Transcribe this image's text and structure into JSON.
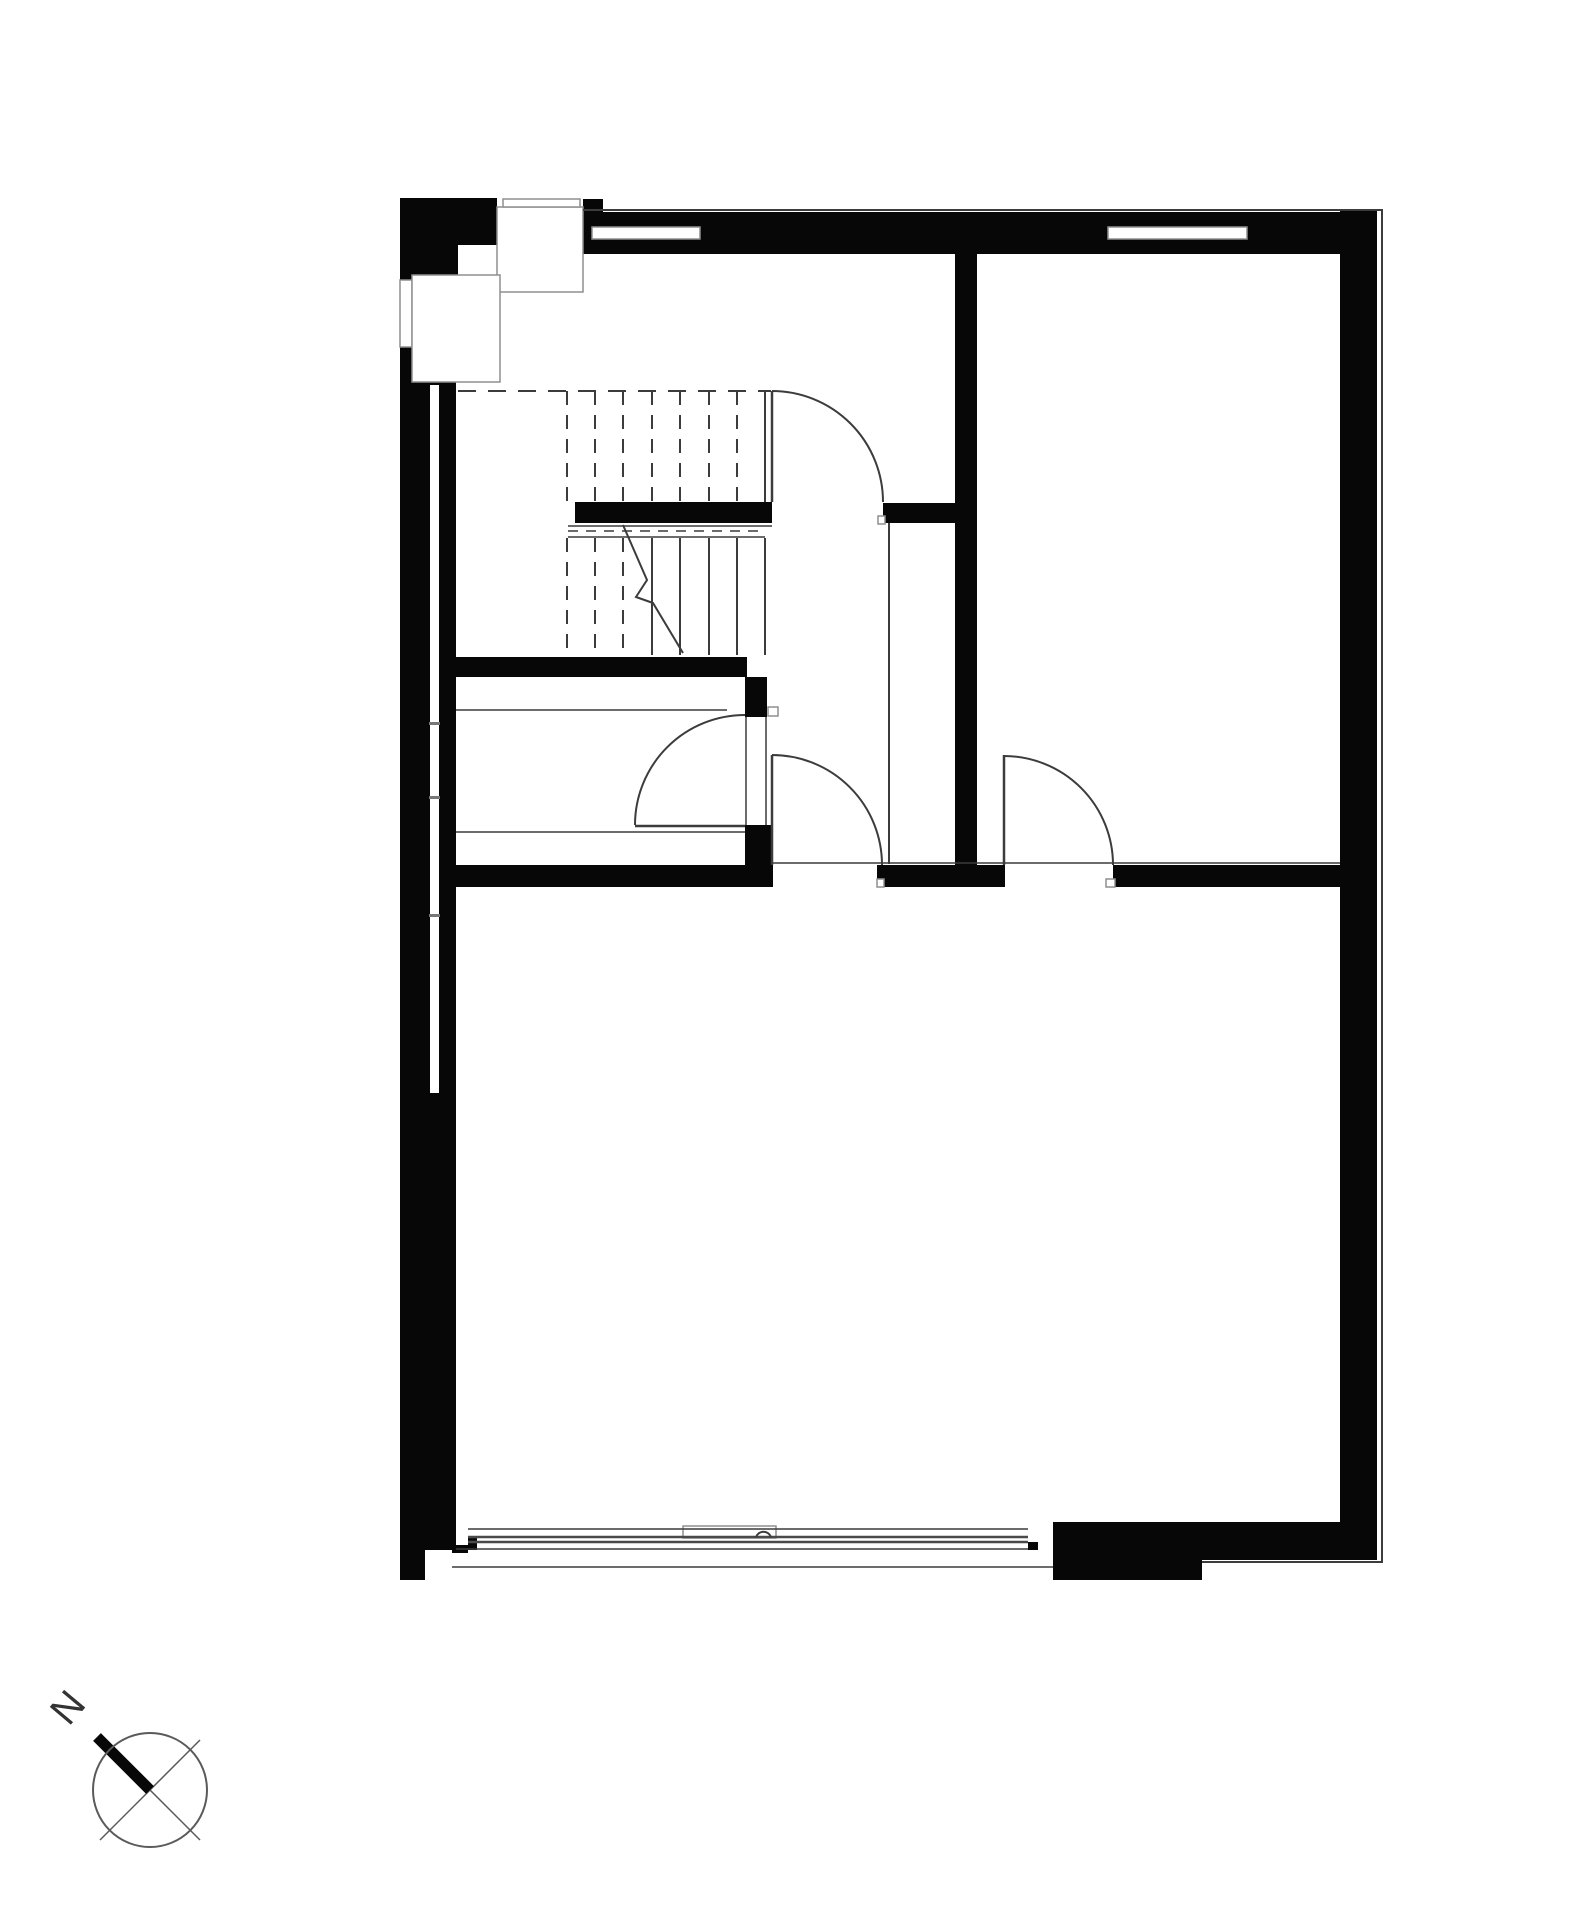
{
  "title": "ground-floor-plan",
  "canvas": {
    "w": 1584,
    "h": 1920,
    "bg": "#ffffff"
  },
  "colors": {
    "wall": "#070707",
    "white": "#ffffff",
    "thin": "#3c3c3c",
    "outline": "#8f8f8f",
    "glass": "#4a4a4a",
    "tick": "#777777",
    "ring": "#5a5a5a",
    "text": "#333333"
  },
  "compass": {
    "label": "N"
  },
  "plan": {
    "rects": [
      {
        "n": "left-exterior-wall",
        "x": 400,
        "y": 198,
        "w": 56,
        "h": 1352,
        "f": "wall"
      },
      {
        "n": "left-wall-foot",
        "x": 400,
        "y": 1550,
        "w": 25,
        "h": 30,
        "f": "wall"
      },
      {
        "n": "sill-stub",
        "x": 452,
        "y": 1545,
        "w": 16,
        "h": 8,
        "f": "wall"
      },
      {
        "n": "top-left-chimney-block-a",
        "x": 400,
        "y": 198,
        "w": 97,
        "h": 47,
        "f": "wall"
      },
      {
        "n": "top-left-chimney-block-b",
        "x": 400,
        "y": 245,
        "w": 58,
        "h": 57,
        "f": "wall"
      },
      {
        "n": "chimney-right-strip",
        "x": 583,
        "y": 199,
        "w": 20,
        "h": 55,
        "f": "wall"
      },
      {
        "n": "top-exterior-wall",
        "x": 497,
        "y": 212,
        "w": 843,
        "h": 42,
        "f": "wall"
      },
      {
        "n": "right-exterior-wall",
        "x": 1340,
        "y": 210,
        "w": 37,
        "h": 1341,
        "f": "wall"
      },
      {
        "n": "stair-landing-half-wall",
        "x": 575,
        "y": 502,
        "w": 197,
        "h": 21,
        "f": "wall"
      },
      {
        "n": "stair-hall-wall-segment",
        "x": 883,
        "y": 503,
        "w": 74,
        "h": 20,
        "f": "wall"
      },
      {
        "n": "interior-wall-vertical",
        "x": 955,
        "y": 254,
        "w": 22,
        "h": 611,
        "f": "wall"
      },
      {
        "n": "under-stair-wall",
        "x": 456,
        "y": 657,
        "w": 291,
        "h": 20,
        "f": "wall"
      },
      {
        "n": "closet-door-jamb-upper",
        "x": 745,
        "y": 677,
        "w": 22,
        "h": 40,
        "f": "wall"
      },
      {
        "n": "closet-door-jamb-lower",
        "x": 745,
        "y": 825,
        "w": 28,
        "h": 62,
        "f": "wall"
      },
      {
        "n": "mid-wall-left",
        "x": 456,
        "y": 865,
        "w": 316,
        "h": 22,
        "f": "wall"
      },
      {
        "n": "mid-wall-center",
        "x": 877,
        "y": 865,
        "w": 128,
        "h": 22,
        "f": "wall"
      },
      {
        "n": "mid-wall-right",
        "x": 1113,
        "y": 865,
        "w": 227,
        "h": 22,
        "f": "wall"
      },
      {
        "n": "bottom-right-wall-block",
        "x": 1053,
        "y": 1522,
        "w": 324,
        "h": 38,
        "f": "wall"
      },
      {
        "n": "bottom-right-wall-step",
        "x": 1053,
        "y": 1560,
        "w": 149,
        "h": 20,
        "f": "wall"
      },
      {
        "n": "glass-end-tick-left",
        "x": 468,
        "y": 1538,
        "w": 9,
        "h": 12,
        "f": "wall"
      },
      {
        "n": "glass-end-tick-right",
        "x": 1028,
        "y": 1542,
        "w": 10,
        "h": 8,
        "f": "wall"
      },
      {
        "n": "chimney-square-b",
        "x": 458,
        "y": 245,
        "w": 39,
        "h": 48,
        "f": "white"
      },
      {
        "n": "left-wall-window-slot",
        "x": 430,
        "y": 385,
        "w": 9,
        "h": 708,
        "f": "white"
      },
      {
        "n": "top-window-1",
        "x": 592,
        "y": 227,
        "w": 108,
        "h": 12,
        "f": "white",
        "s": "outline"
      },
      {
        "n": "top-window-2",
        "x": 1108,
        "y": 227,
        "w": 139,
        "h": 12,
        "f": "white",
        "s": "outline"
      },
      {
        "n": "left-window-upper",
        "x": 400,
        "y": 280,
        "w": 12,
        "h": 67,
        "f": "white",
        "s": "outline"
      },
      {
        "n": "chimney-square-a",
        "x": 497,
        "y": 207,
        "w": 86,
        "h": 85,
        "f": "white",
        "s": "outline"
      },
      {
        "n": "chimney-top-bar",
        "x": 503,
        "y": 199,
        "w": 77,
        "h": 8,
        "f": "white",
        "s": "outline"
      },
      {
        "n": "chimney-square-c",
        "x": 412,
        "y": 275,
        "w": 88,
        "h": 107,
        "f": "white",
        "s": "outline"
      },
      {
        "n": "sliding-door-leaf",
        "x": 683,
        "y": 1526,
        "w": 93,
        "h": 12,
        "f": "white",
        "s": "outline"
      },
      {
        "n": "door-stop-stairs",
        "x": 878,
        "y": 516,
        "w": 7,
        "h": 8,
        "f": "white",
        "s": "outline"
      },
      {
        "n": "door-stop-closet",
        "x": 768,
        "y": 707,
        "w": 10,
        "h": 9,
        "f": "white",
        "s": "outline"
      },
      {
        "n": "door-stop-hall",
        "x": 877,
        "y": 879,
        "w": 7,
        "h": 8,
        "f": "white",
        "s": "outline"
      },
      {
        "n": "door-stop-bedroom",
        "x": 1106,
        "y": 879,
        "w": 9,
        "h": 8,
        "f": "white",
        "s": "outline"
      },
      {
        "n": "slot-tick-1",
        "x": 429,
        "y": 722,
        "w": 11,
        "h": 3,
        "f": "tick"
      },
      {
        "n": "slot-tick-2",
        "x": 429,
        "y": 796,
        "w": 11,
        "h": 3,
        "f": "tick"
      },
      {
        "n": "slot-tick-3",
        "x": 429,
        "y": 914,
        "w": 11,
        "h": 3,
        "f": "tick"
      }
    ],
    "lines": [
      {
        "n": "top-facade-outline",
        "x1": 583,
        "y1": 210,
        "x2": 1383,
        "y2": 210,
        "w": 2
      },
      {
        "n": "right-facade-outline",
        "x1": 1382,
        "y1": 210,
        "x2": 1382,
        "y2": 1562,
        "w": 2
      },
      {
        "n": "stair-top-dashed-line",
        "x1": 458,
        "y1": 391,
        "x2": 771,
        "y2": 391,
        "w": 2,
        "d": "18 12"
      },
      {
        "n": "stair-right-edge",
        "x1": 765,
        "y1": 391,
        "x2": 765,
        "y2": 502,
        "w": 2
      },
      {
        "n": "stair-door-leaf",
        "x1": 772,
        "y1": 391,
        "x2": 772,
        "y2": 502,
        "w": 2.5
      },
      {
        "n": "landing-under-line-1",
        "x1": 568,
        "y1": 526,
        "x2": 772,
        "y2": 526,
        "w": 1.5
      },
      {
        "n": "landing-under-dashed",
        "x1": 568,
        "y1": 531,
        "x2": 765,
        "y2": 531,
        "w": 1.5,
        "d": "10 8"
      },
      {
        "n": "landing-under-line-2",
        "x1": 568,
        "y1": 537,
        "x2": 765,
        "y2": 537,
        "w": 1.5
      },
      {
        "n": "stair-riser-u1",
        "x1": 567,
        "y1": 391,
        "x2": 567,
        "y2": 501,
        "w": 2,
        "d": "14 10"
      },
      {
        "n": "stair-riser-u2",
        "x1": 595,
        "y1": 391,
        "x2": 595,
        "y2": 501,
        "w": 2,
        "d": "14 10"
      },
      {
        "n": "stair-riser-u3",
        "x1": 623,
        "y1": 391,
        "x2": 623,
        "y2": 501,
        "w": 2,
        "d": "14 10"
      },
      {
        "n": "stair-riser-u4",
        "x1": 652,
        "y1": 391,
        "x2": 652,
        "y2": 501,
        "w": 2,
        "d": "14 10"
      },
      {
        "n": "stair-riser-u5",
        "x1": 680,
        "y1": 391,
        "x2": 680,
        "y2": 501,
        "w": 2,
        "d": "14 10"
      },
      {
        "n": "stair-riser-u6",
        "x1": 709,
        "y1": 391,
        "x2": 709,
        "y2": 501,
        "w": 2,
        "d": "14 10"
      },
      {
        "n": "stair-riser-u7",
        "x1": 737,
        "y1": 391,
        "x2": 737,
        "y2": 501,
        "w": 2,
        "d": "14 10"
      },
      {
        "n": "stair-riser-l1",
        "x1": 567,
        "y1": 538,
        "x2": 567,
        "y2": 655,
        "w": 2,
        "d": "14 10"
      },
      {
        "n": "stair-riser-l2",
        "x1": 595,
        "y1": 538,
        "x2": 595,
        "y2": 655,
        "w": 2,
        "d": "14 10"
      },
      {
        "n": "stair-riser-l3",
        "x1": 623,
        "y1": 538,
        "x2": 623,
        "y2": 655,
        "w": 2,
        "d": "14 10"
      },
      {
        "n": "stair-riser-l4",
        "x1": 652,
        "y1": 538,
        "x2": 652,
        "y2": 655,
        "w": 2
      },
      {
        "n": "stair-riser-l5",
        "x1": 680,
        "y1": 538,
        "x2": 680,
        "y2": 655,
        "w": 2
      },
      {
        "n": "stair-riser-l6",
        "x1": 709,
        "y1": 538,
        "x2": 709,
        "y2": 655,
        "w": 2
      },
      {
        "n": "stair-riser-l7",
        "x1": 737,
        "y1": 538,
        "x2": 737,
        "y2": 655,
        "w": 2
      },
      {
        "n": "stair-riser-l8",
        "x1": 765,
        "y1": 538,
        "x2": 765,
        "y2": 655,
        "w": 2
      },
      {
        "n": "hall-partition-line",
        "x1": 889,
        "y1": 523,
        "x2": 889,
        "y2": 864,
        "w": 2
      },
      {
        "n": "closet-shelf-line-1",
        "x1": 456,
        "y1": 710,
        "x2": 727,
        "y2": 710,
        "w": 1.5
      },
      {
        "n": "closet-shelf-line-2",
        "x1": 456,
        "y1": 832,
        "x2": 745,
        "y2": 832,
        "w": 1.5
      },
      {
        "n": "closet-door-frame-left",
        "x1": 746,
        "y1": 717,
        "x2": 746,
        "y2": 825,
        "w": 1.5
      },
      {
        "n": "closet-door-frame-right",
        "x1": 766,
        "y1": 717,
        "x2": 766,
        "y2": 825,
        "w": 1.5
      },
      {
        "n": "closet-door-leaf",
        "x1": 635,
        "y1": 826,
        "x2": 745,
        "y2": 826,
        "w": 2.5
      },
      {
        "n": "hall-door-leaf",
        "x1": 772,
        "y1": 755,
        "x2": 772,
        "y2": 865,
        "w": 2.5
      },
      {
        "n": "bedroom-door-leaf",
        "x1": 1004,
        "y1": 755,
        "x2": 1004,
        "y2": 865,
        "w": 2.5
      },
      {
        "n": "mid-wall-top-line",
        "x1": 772,
        "y1": 863,
        "x2": 1340,
        "y2": 863,
        "w": 1.5
      },
      {
        "n": "slider-track-top",
        "x1": 468,
        "y1": 1529,
        "x2": 1028,
        "y2": 1529,
        "w": 1.5
      },
      {
        "n": "slider-glass-line-1",
        "x1": 468,
        "y1": 1537,
        "x2": 1028,
        "y2": 1537,
        "w": 2.5,
        "c": "glass"
      },
      {
        "n": "slider-glass-line-2",
        "x1": 468,
        "y1": 1542,
        "x2": 1028,
        "y2": 1542,
        "w": 2.5,
        "c": "glass"
      },
      {
        "n": "slider-track-mid",
        "x1": 456,
        "y1": 1549,
        "x2": 1028,
        "y2": 1549,
        "w": 1.5
      },
      {
        "n": "slider-sill-line",
        "x1": 452,
        "y1": 1567,
        "x2": 1053,
        "y2": 1567,
        "w": 1.5
      },
      {
        "n": "bottom-right-outline",
        "x1": 1202,
        "y1": 1562,
        "x2": 1383,
        "y2": 1562,
        "w": 2
      },
      {
        "n": "compass-cross-nw-se",
        "x1": 100,
        "y1": 1740,
        "x2": 200,
        "y2": 1840,
        "w": 1.5,
        "c": "ring"
      },
      {
        "n": "compass-cross-sw-ne",
        "x1": 100,
        "y1": 1840,
        "x2": 200,
        "y2": 1740,
        "w": 1.5,
        "c": "ring"
      },
      {
        "n": "compass-needle",
        "x1": 150,
        "y1": 1790,
        "x2": 97,
        "y2": 1737,
        "w": 11,
        "c": "wall"
      }
    ],
    "paths": [
      {
        "n": "stair-door-arc",
        "d": "M 772 391 A 111 111 0 0 1 883 502",
        "w": 2
      },
      {
        "n": "closet-door-arc",
        "d": "M 635 825 A 110 110 0 0 1 745 715",
        "w": 2
      },
      {
        "n": "hall-door-arc",
        "d": "M 772 755 A 110 110 0 0 1 882 865",
        "w": 2
      },
      {
        "n": "bedroom-door-arc",
        "d": "M 1004 756 A 109 109 0 0 1 1113 865",
        "w": 2
      },
      {
        "n": "stair-cut-line",
        "d": "M 623 525 L 647 580 L 636 597 L 653 603 L 683 653",
        "w": 2
      },
      {
        "n": "slider-handle",
        "d": "M 756 1537 A 8 8 0 0 1 771 1537",
        "w": 2
      }
    ],
    "circles": [
      {
        "n": "compass-ring",
        "cx": 150,
        "cy": 1790,
        "r": 57,
        "w": 2,
        "c": "ring"
      }
    ],
    "texts": [
      {
        "n": "compass-north-label",
        "bind": "compass.label",
        "x": 78,
        "y": 1716,
        "rot": -50,
        "size": 40
      }
    ]
  }
}
